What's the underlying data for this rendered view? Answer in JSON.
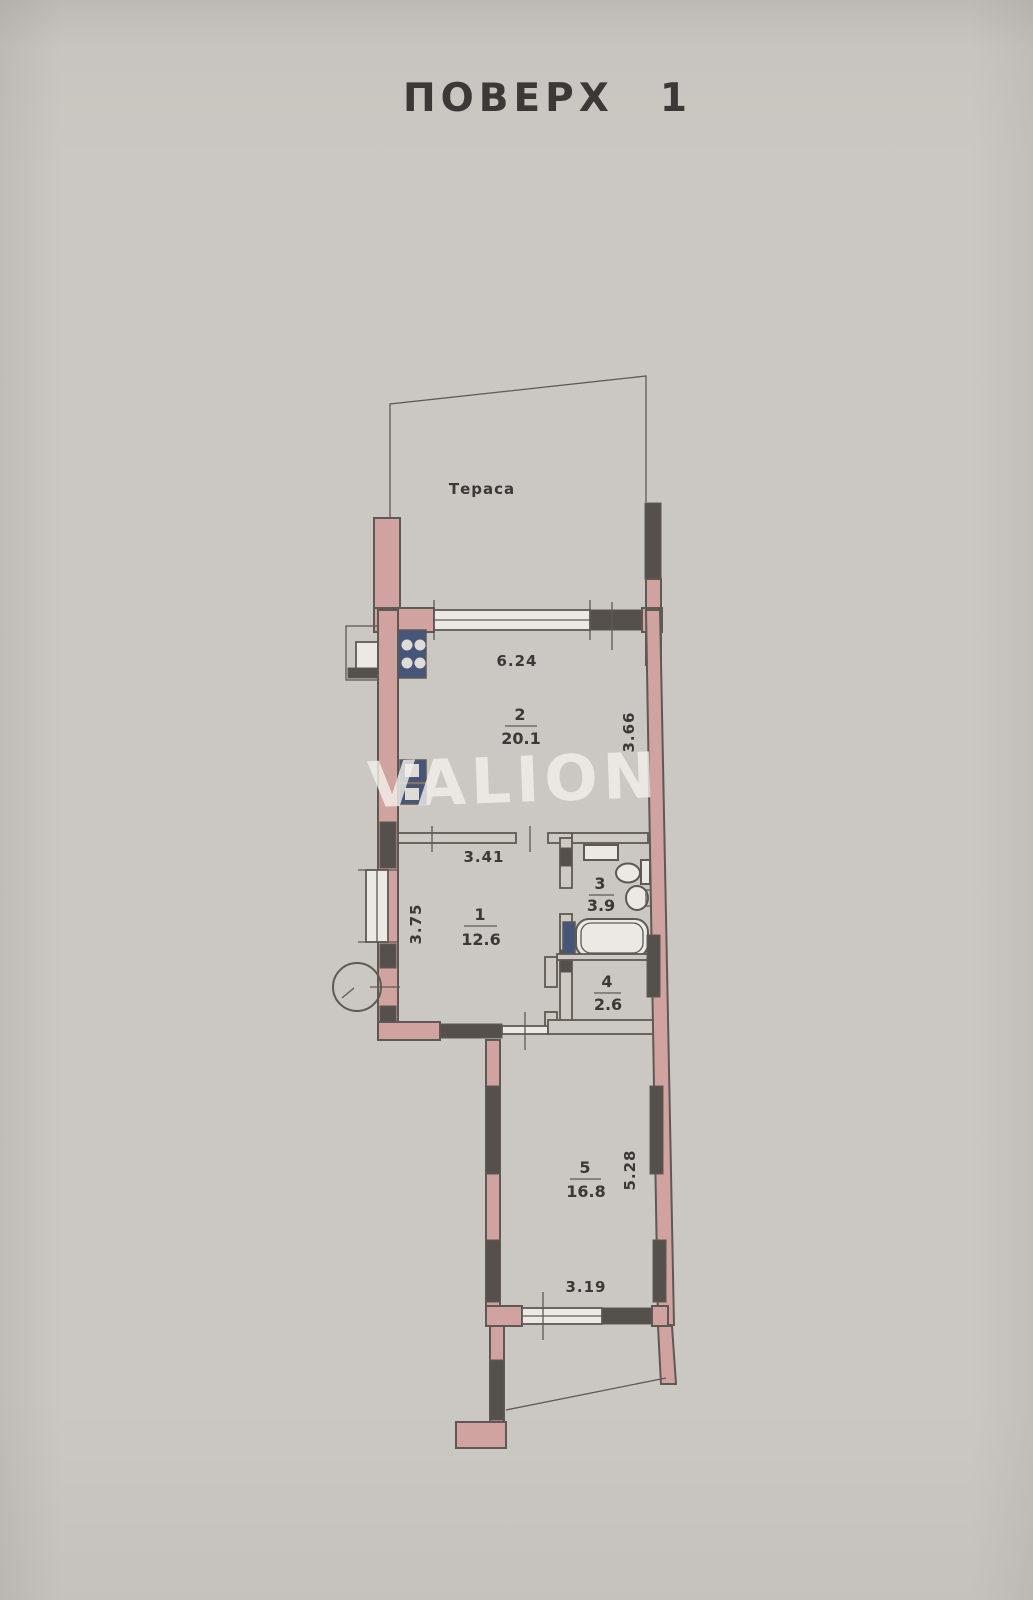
{
  "page": {
    "title_word": "ПОВЕРХ",
    "title_number": "1",
    "watermark": "VALION"
  },
  "plan": {
    "terrace_label": "Тераса",
    "rooms": {
      "room1": {
        "number": "1",
        "area": "12.6"
      },
      "room2": {
        "number": "2",
        "area": "20.1"
      },
      "room3": {
        "number": "3",
        "area": "3.9"
      },
      "room4": {
        "number": "4",
        "area": "2.6"
      },
      "room5": {
        "number": "5",
        "area": "16.8"
      }
    },
    "dimensions": {
      "room2_top_width": "6.24",
      "room2_right_height": "3.66",
      "room1_top_width": "3.41",
      "room1_left_height": "3.75",
      "room5_right_height": "5.28",
      "room5_bottom_width": "3.19"
    },
    "colors": {
      "background": "#cbc7c2",
      "wall_fill": "#d1a3a0",
      "wall_dark": "#55504c",
      "line": "#5e5954",
      "text": "#3b3835",
      "fixture_blue": "#46567a",
      "watermark": "rgba(242,240,236,0.8)"
    }
  }
}
